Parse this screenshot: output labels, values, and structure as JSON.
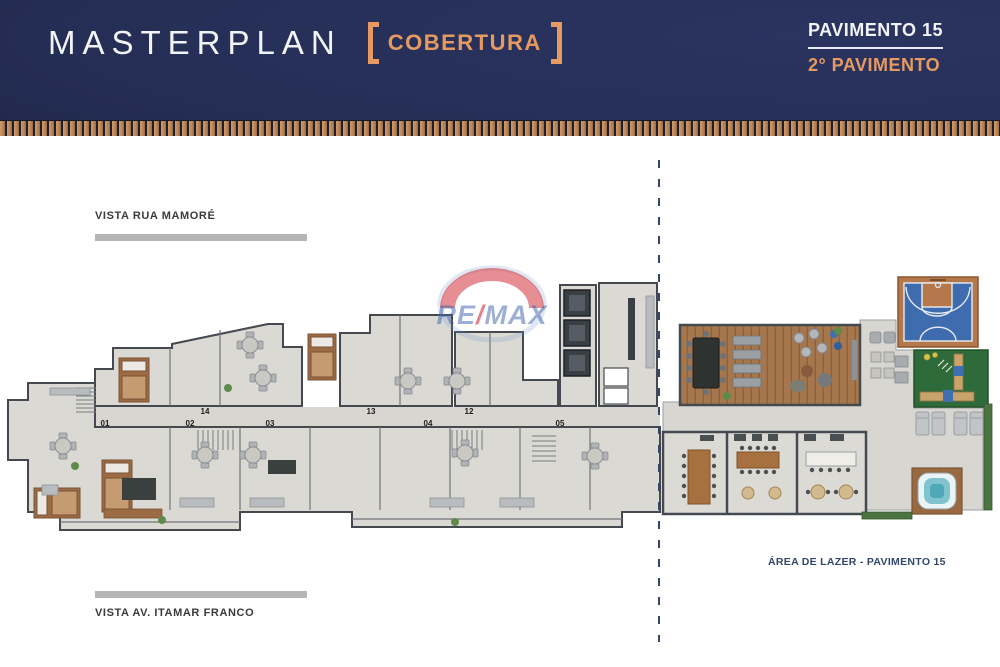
{
  "header": {
    "title": "MASTERPLAN",
    "tag": "COBERTURA",
    "floor_primary": "PAVIMENTO 15",
    "floor_secondary": "2° PAVIMENTO"
  },
  "labels": {
    "top_street": "VISTA RUA MAMORÉ",
    "bottom_street": "VISTA AV. ITAMAR FRANCO",
    "leisure": "ÁREA DE LAZER - PAVIMENTO 15"
  },
  "watermark": {
    "re": "RE",
    "slash": "/",
    "max": "MAX"
  },
  "units": {
    "top": [
      "14",
      "13",
      "12"
    ],
    "bottom": [
      "01",
      "02",
      "03",
      "04",
      "05"
    ]
  },
  "colors": {
    "header_navy": "#252e55",
    "accent_orange": "#e69a62",
    "wood_strip_tan": "#c28c5c",
    "divider_blue": "#39446a",
    "court_blue": "#3e6cae",
    "court_frame": "#b5784a",
    "turf_green": "#2f6b3a",
    "wood_floor": "#a6764c",
    "floor_gray": "#dbd9d4",
    "wall_gray": "#454a51",
    "street_bar_gray": "#b6b6b6",
    "watermark_red": "#cd1e28",
    "watermark_blue": "#3c5faa"
  }
}
